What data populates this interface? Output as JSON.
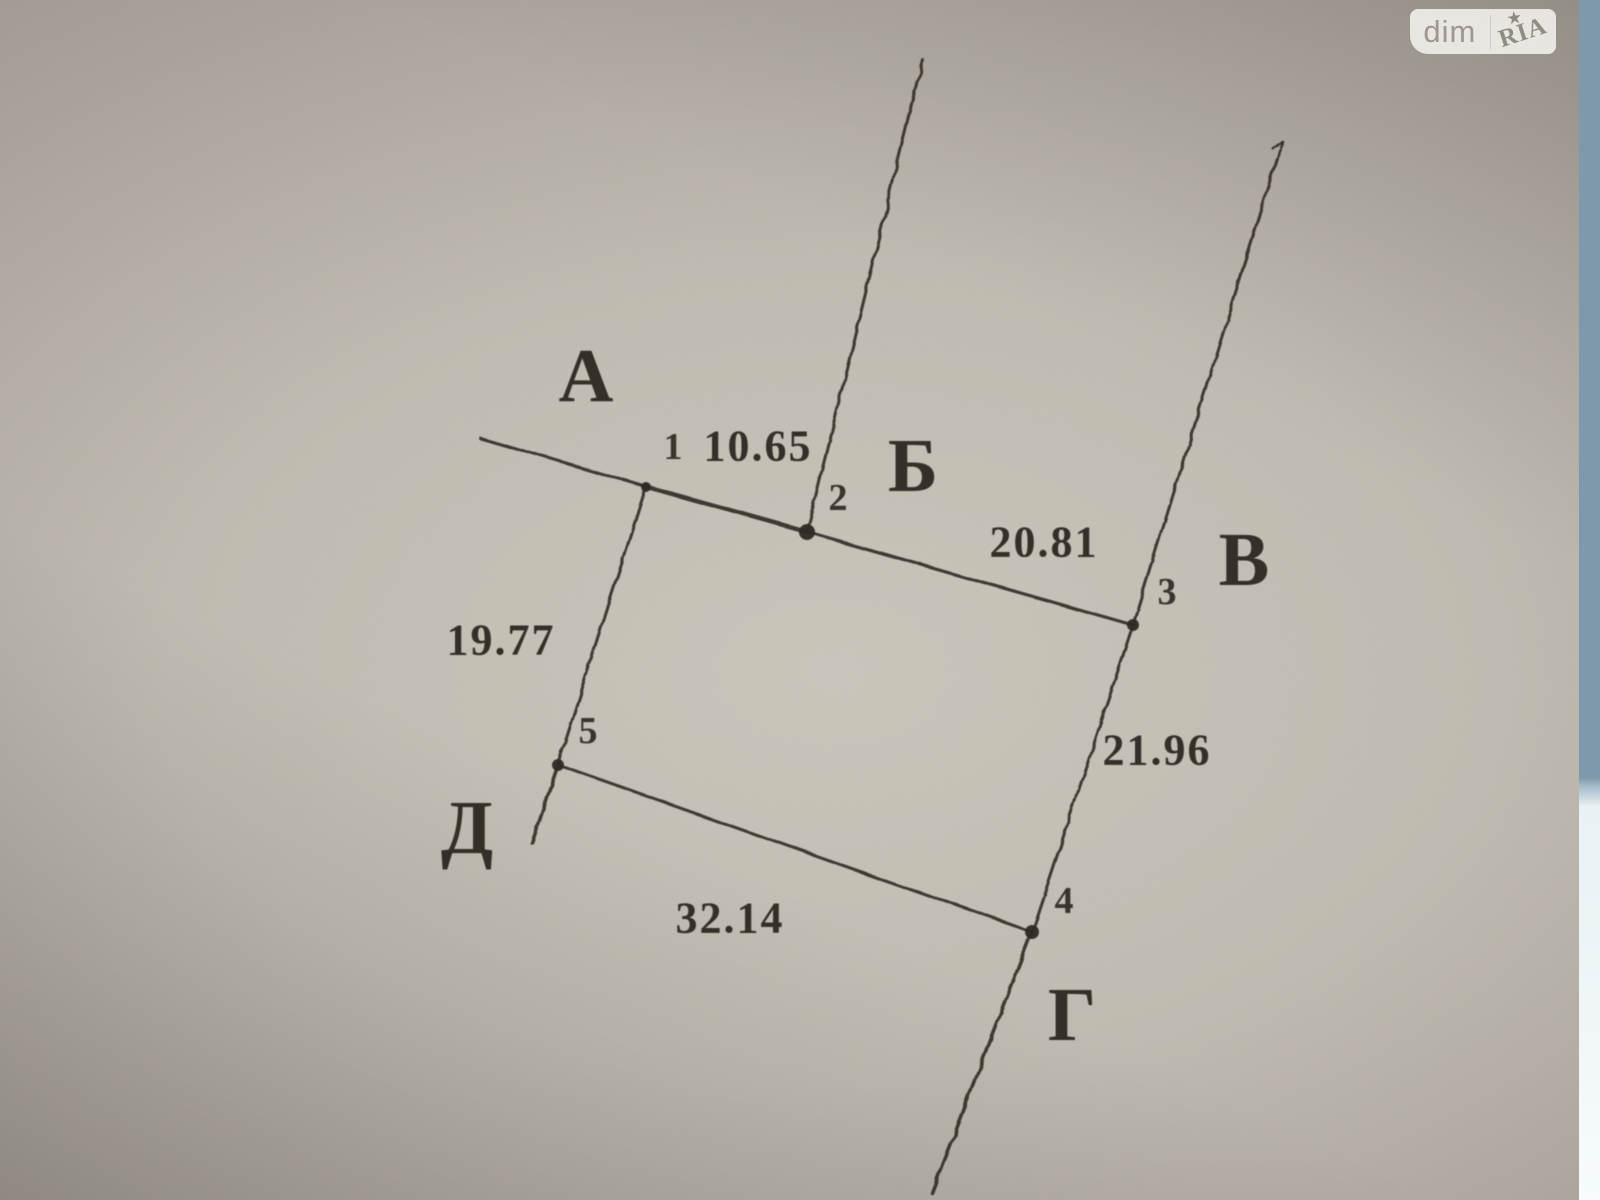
{
  "watermark": {
    "left": "dim",
    "right": "RIA",
    "star": "★"
  },
  "page": {
    "paper_light": "#cbc7bc",
    "paper_dark": "#948e85",
    "edge_blue": "#7e99ab",
    "edge_white": "#f7fbfc",
    "ink": "#2e2923"
  },
  "diagram": {
    "description": "hand-drawn cadastral land plot sketch, vertices 1-5, adjacent boundaries lettered А-Д",
    "points": [
      {
        "id": "1",
        "x": 646,
        "y": 487,
        "r": 5,
        "label_x": 673,
        "label_y": 447
      },
      {
        "id": "2",
        "x": 807,
        "y": 532,
        "r": 8,
        "label_x": 838,
        "label_y": 498
      },
      {
        "id": "3",
        "x": 1133,
        "y": 625,
        "r": 6,
        "label_x": 1167,
        "label_y": 592
      },
      {
        "id": "4",
        "x": 1032,
        "y": 932,
        "r": 7,
        "label_x": 1064,
        "label_y": 901
      },
      {
        "id": "5",
        "x": 558,
        "y": 765,
        "r": 6,
        "label_x": 588,
        "label_y": 731
      }
    ],
    "segments": [
      {
        "name": "fence-a-west",
        "x1": 480,
        "y1": 438,
        "x2": 646,
        "y2": 487,
        "w": 3.0
      },
      {
        "name": "side-1-2",
        "x1": 646,
        "y1": 487,
        "x2": 807,
        "y2": 532,
        "w": 4.5
      },
      {
        "name": "fence-b-north",
        "x1": 807,
        "y1": 531,
        "x2": 923,
        "y2": 60,
        "w": 3.0
      },
      {
        "name": "side-2-3",
        "x1": 807,
        "y1": 532,
        "x2": 1133,
        "y2": 625,
        "w": 3.2
      },
      {
        "name": "fence-v-north",
        "x1": 1133,
        "y1": 625,
        "x2": 1277,
        "y2": 158,
        "w": 3.0
      },
      {
        "name": "fence-v-hook",
        "x1": 1277,
        "y1": 158,
        "x2": 1284,
        "y2": 143,
        "w": 2.5
      },
      {
        "name": "fence-v-tick",
        "x1": 1284,
        "y1": 143,
        "x2": 1272,
        "y2": 148,
        "w": 2.2
      },
      {
        "name": "side-3-4",
        "x1": 1133,
        "y1": 625,
        "x2": 1032,
        "y2": 932,
        "w": 3.0
      },
      {
        "name": "fence-g-south",
        "x1": 1032,
        "y1": 932,
        "x2": 932,
        "y2": 1193,
        "w": 3.5
      },
      {
        "name": "side-1-5",
        "x1": 646,
        "y1": 487,
        "x2": 558,
        "y2": 765,
        "w": 3.0
      },
      {
        "name": "fence-d-tail",
        "x1": 558,
        "y1": 765,
        "x2": 532,
        "y2": 843,
        "w": 3.5
      },
      {
        "name": "side-5-4",
        "x1": 558,
        "y1": 765,
        "x2": 1032,
        "y2": 932,
        "w": 3.0
      }
    ],
    "boundary_letters": [
      {
        "text": "А",
        "x": 586,
        "y": 376
      },
      {
        "text": "Б",
        "x": 913,
        "y": 466
      },
      {
        "text": "В",
        "x": 1244,
        "y": 560
      },
      {
        "text": "Г",
        "x": 1072,
        "y": 1015
      },
      {
        "text": "Д",
        "x": 467,
        "y": 828
      }
    ],
    "distance_labels": [
      {
        "text": "10.65",
        "x": 758,
        "y": 446
      },
      {
        "text": "20.81",
        "x": 1044,
        "y": 542
      },
      {
        "text": "19.77",
        "x": 501,
        "y": 640
      },
      {
        "text": "21.96",
        "x": 1157,
        "y": 750
      },
      {
        "text": "32.14",
        "x": 730,
        "y": 918
      }
    ]
  }
}
